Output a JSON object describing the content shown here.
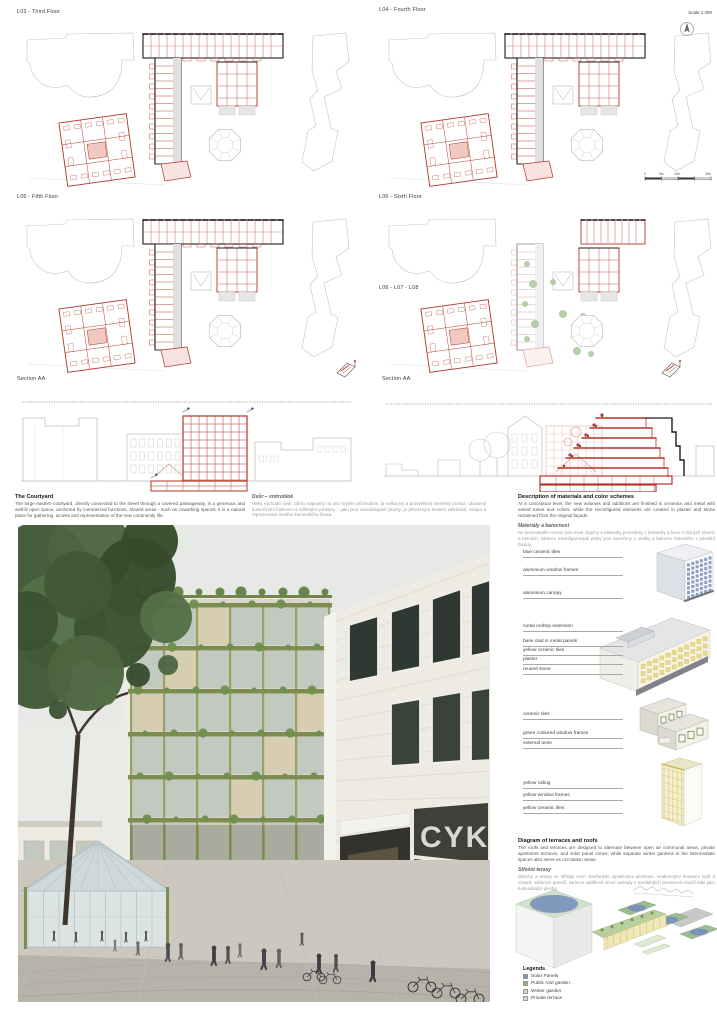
{
  "header": {
    "scale_note": "Scale 1:400"
  },
  "plans": [
    {
      "label": "L03 - Third Floor"
    },
    {
      "label": "L04 - Fourth Floor"
    },
    {
      "label": "L05 - Fifth Floor"
    },
    {
      "label": "L06 - Sixth Floor"
    },
    {
      "label": "L06 - L07 - L08"
    }
  ],
  "sections": {
    "left_label": "Section AA",
    "right_label": "Section AA"
  },
  "scalebar": {
    "labels": [
      "0",
      "5m",
      "10m",
      "20m"
    ]
  },
  "texts": {
    "courtyard": {
      "title": "The Courtyard",
      "body": "The large eastern courtyard, directly connected to the street through a covered passageway, is a generous and well-lit open space, anchored by commercial functions, shared areas - such as coworking spaces; it is a natural place for gathering, access and representation of the new community life."
    },
    "courtyard_cz": {
      "title": "Dvůr – vnitroblok",
      "body": "Velký východní dvůr, přímo napojený na ulici krytým průchodem, je velkorysý a prosvětlený otevřený prostor, ukotvený komerčními funkcemi a sdílenými prostory – jako jsou coworkingové plochy; je přirozeným místem setkávání, vstupu a reprezentace nového komunitního života."
    },
    "materials": {
      "title": "Description of materials and color schemes",
      "body": "At a conceptual level, the new volumes and additions are finished in ceramics and metal with varied tones and colors, while the reconfigured elements are created in plaster and stone reclaimed from the original façade.",
      "subtitle": "Materiály a barevnost",
      "subbody": "Na konceptuální úrovni jsou nové objemy a nástavby provedeny z keramiky a kovu v různých tónech a barvách, zatímco rekonfigurované prvky jsou vytvořeny z omítky a kamene získaného z původní fasády."
    },
    "terraces": {
      "title": "Diagram of terraces and roofs",
      "body": "The roofs and terraces are designed to alternate between open air communal areas, private apartment terraces, and solar panel zones, while separate winter gardens in the intermediate spaces also serve as circulation areas.",
      "subtitle": "Střešní terasy",
      "subbody": "Střechy a terasy se střídají mezi otevřenými společnými plochami, soukromými terasami bytů a zónami solárních panelů, zatímco oddělené zimní zahrady v mezilehlých prostorech slouží také jako komunikační plochy."
    }
  },
  "materials_labels": {
    "group1": [
      "blue ceramic tiles",
      "aluminium window frames",
      "aluminium canopy"
    ],
    "group2": [
      "metal rooftop extension",
      "base clad in metal panels",
      "yellow ceramic tiles",
      "plaster",
      "reused stone"
    ],
    "group3": [
      "ceramic tiles",
      "green coloured window frames",
      "external tents"
    ],
    "group4": [
      "yellow railing",
      "yellow window frames",
      "yellow ceramic tiles"
    ]
  },
  "legends": {
    "title": "Legends",
    "items": [
      {
        "label": "Solar Panels",
        "color": "#7b93b8"
      },
      {
        "label": "Public roof garden",
        "color": "#8fae7e"
      },
      {
        "label": "Winter garden",
        "color": "#d4dc9e"
      },
      {
        "label": "Private terrace",
        "color": "#d9d9d4"
      }
    ]
  },
  "render": {
    "storefront_sign": "CYK"
  },
  "colors": {
    "new_construction_red": "#b63326",
    "existing_black": "#1c1c1c",
    "site_gray": "#c4c4c4",
    "olive_green": "#7d8c50",
    "solar_blue": "#7b93b8",
    "roof_green": "#9dbb8e"
  }
}
